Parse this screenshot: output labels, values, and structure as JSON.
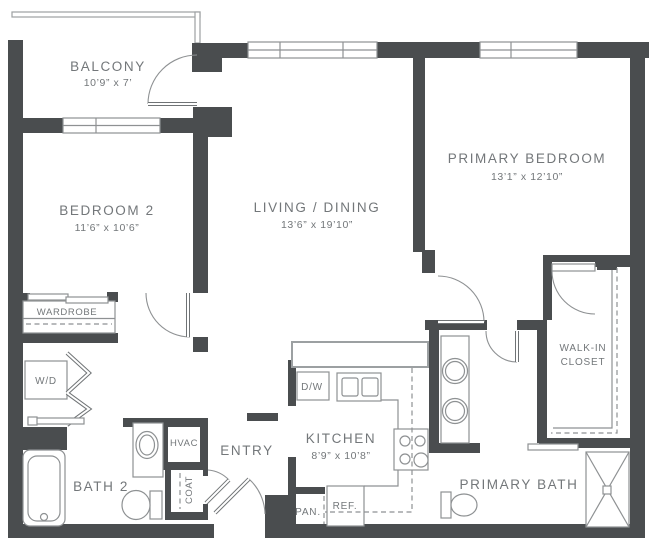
{
  "colors": {
    "wall": "#4a4d4f",
    "line": "#8e9193",
    "text": "#73777a"
  },
  "rooms": {
    "balcony": {
      "name": "BALCONY",
      "dims": "10’9” x 7’"
    },
    "bedroom2": {
      "name": "BEDROOM 2",
      "dims": "11’6” x 10’6”"
    },
    "living_dining": {
      "name": "LIVING / DINING",
      "dims": "13’6” x 19’10”"
    },
    "primary_bedroom": {
      "name": "PRIMARY BEDROOM",
      "dims": "13’1” x 12’10”"
    },
    "kitchen": {
      "name": "KITCHEN",
      "dims": "8’9” x 10’8”"
    },
    "entry": {
      "name": "ENTRY"
    },
    "bath2": {
      "name": "BATH 2"
    },
    "primary_bath": {
      "name": "PRIMARY BATH"
    },
    "walk_in_closet": {
      "line1": "WALK-IN",
      "line2": "CLOSET"
    },
    "wardrobe": {
      "name": "WARDROBE"
    },
    "hvac": {
      "name": "HVAC"
    },
    "coat": {
      "name": "COAT"
    }
  },
  "fixtures": {
    "washer_dryer": "W/D",
    "dishwasher": "D/W",
    "refrigerator": "REF.",
    "pantry": "PAN."
  }
}
